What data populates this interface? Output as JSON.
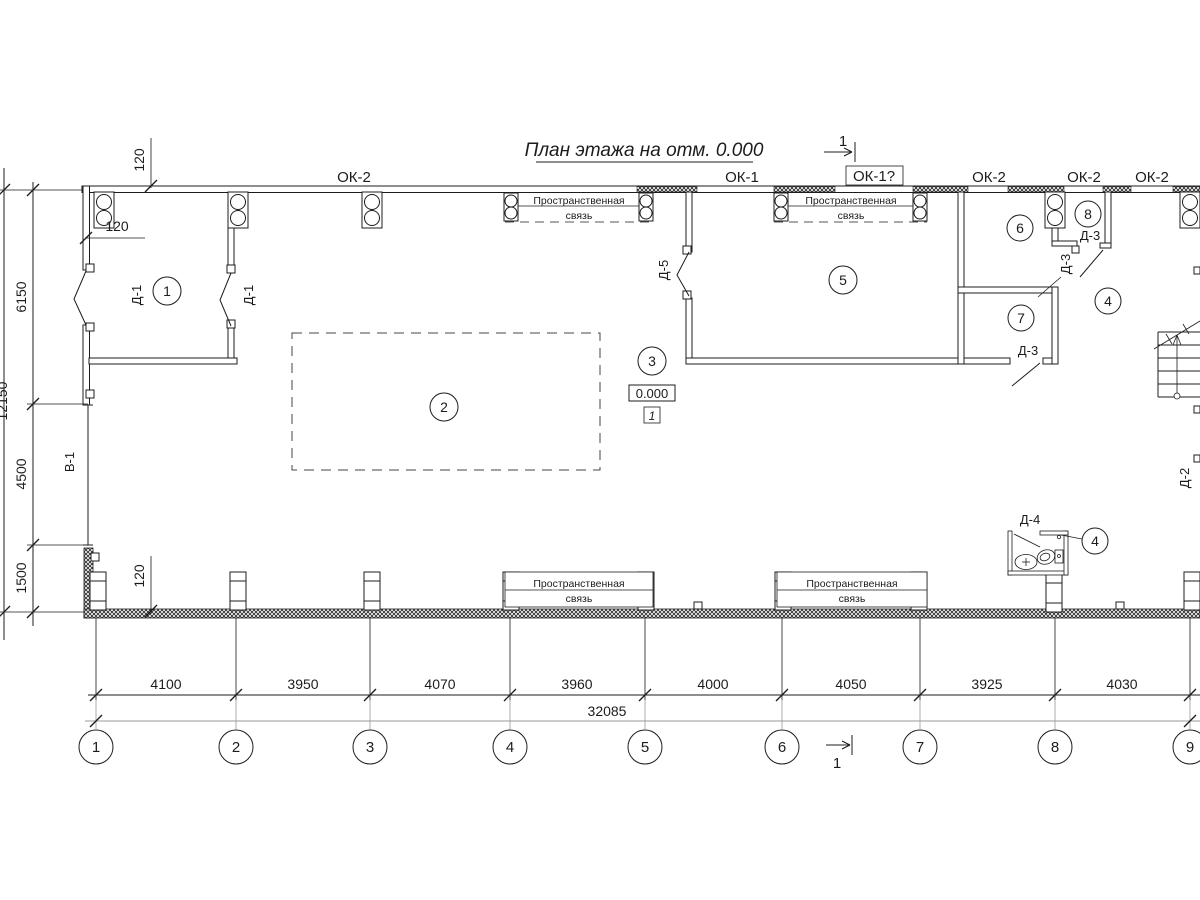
{
  "title": "План этажа на отм. 0.000",
  "elevation_mark": "0.000",
  "detail_mark": "1",
  "section": {
    "number": "1"
  },
  "windows": {
    "ok2": "ОК-2",
    "ok1": "ОК-1",
    "ok1_questioned": "ОК-1?"
  },
  "doors": {
    "d1": "Д-1",
    "d2": "Д-2",
    "d3": "Д-3",
    "d4": "Д-4",
    "d5": "Д-5",
    "gate": "В-1"
  },
  "rooms": {
    "r1": "1",
    "r2": "2",
    "r3": "3",
    "r4": "4",
    "r5": "5",
    "r6": "6",
    "r7": "7",
    "r8": "8"
  },
  "brace": {
    "line1": "Пространственная",
    "line2": "связь"
  },
  "grid_bubbles": [
    "1",
    "2",
    "3",
    "4",
    "5",
    "6",
    "7",
    "8",
    "9"
  ],
  "dims_bottom": [
    "4100",
    "3950",
    "4070",
    "3960",
    "4000",
    "4050",
    "3925",
    "4030"
  ],
  "dims_bottom_total": "32085",
  "dims_left": [
    "6150",
    "4500",
    "1500"
  ],
  "dims_left_total": "12150",
  "dim_offset": "120"
}
